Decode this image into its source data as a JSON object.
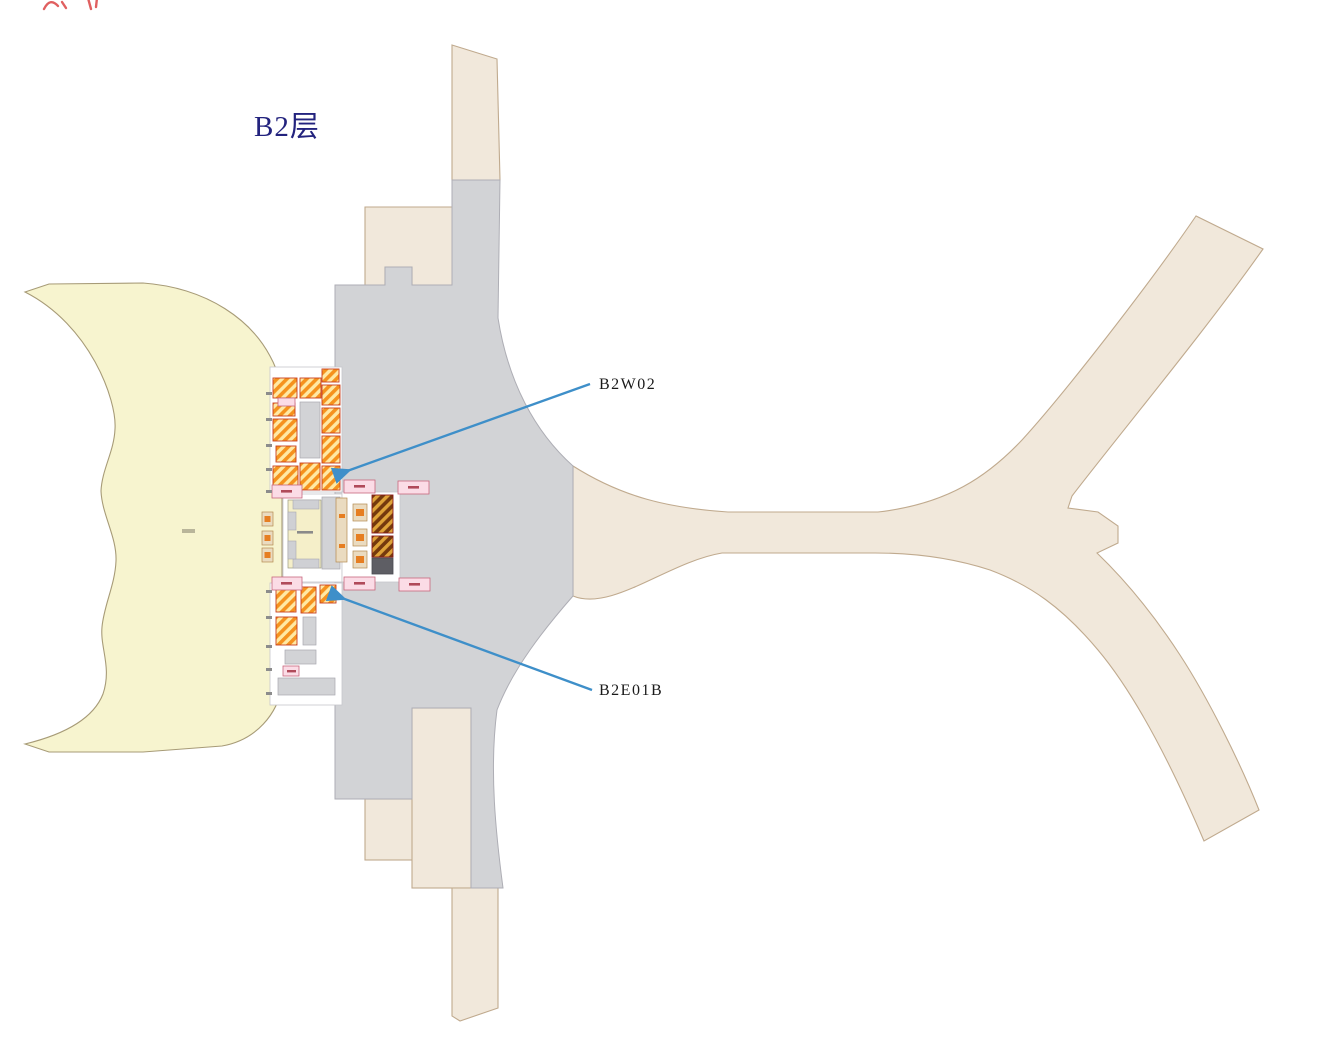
{
  "page": {
    "background": "#FFFFFF",
    "floor_label": "B2层",
    "floor_label_color": "#23237E"
  },
  "annotations": {
    "line_color": "#3E8FC9",
    "label_color": "#1A1A1A",
    "items": [
      {
        "id": "B2W02",
        "label": "B2W02"
      },
      {
        "id": "B2E01B",
        "label": "B2E01B"
      }
    ]
  },
  "map": {
    "regions": [
      {
        "name": "west-satellite-hall",
        "fill": "#F7F4CF",
        "stroke": "#A79B77"
      },
      {
        "name": "central-terminal-core",
        "fill": "#D2D3D6",
        "stroke": "#B3ADA4"
      },
      {
        "name": "landside-road-network",
        "fill": "#F1E8DB",
        "stroke": "#C0AA8E"
      }
    ],
    "detail_colors": {
      "orange_hatch": "#F5921E",
      "orange_hatch_light": "#FFE9A4",
      "orange_block_border": "#C8401F",
      "dark_hatch_base": "#74390E",
      "dark_hatch_stripe": "#DFA339",
      "dark_block_border": "#8B1A1A",
      "pink_room": "#FBDCE6",
      "pink_room_border": "#C9677E",
      "dark_gray_block": "#5E5E64",
      "island_cream": "#F5EFC9",
      "kiosk_beige": "#EADBC0",
      "kiosk_accent": "#E67E22",
      "wall_gray": "#C6C6CC"
    },
    "fragment_color": "#E06060"
  }
}
